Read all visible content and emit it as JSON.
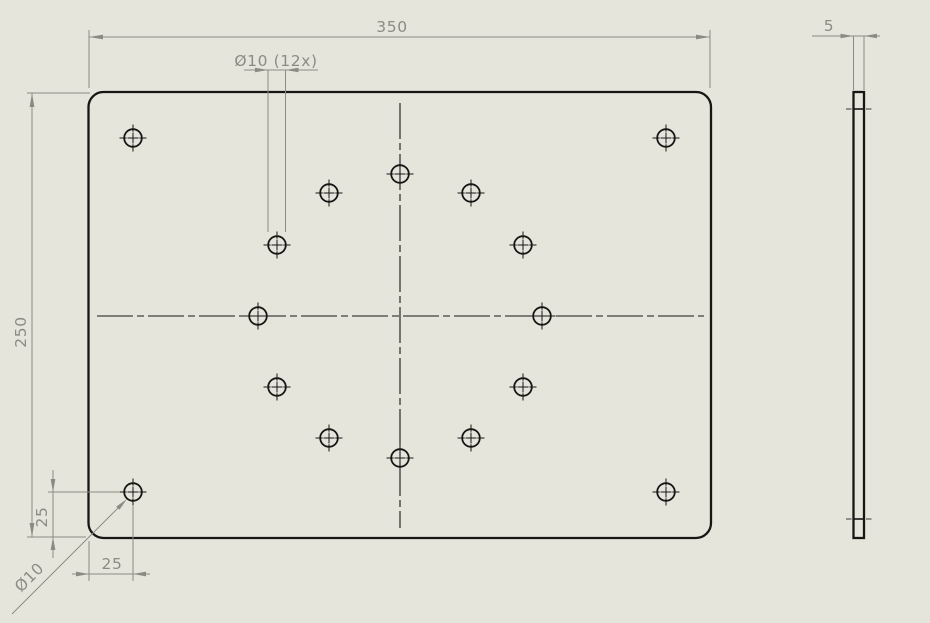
{
  "sheet": {
    "type": "cad-drawing",
    "background": "#e6e5dc",
    "geometry_color": "#161614",
    "dimension_color": "#8b8b85"
  },
  "views": {
    "front": {
      "plate_width_mm": 350,
      "plate_height_mm": 250,
      "hole_diameter_mm": 10,
      "pattern_hole_count": 12,
      "corner_offset_mm": 25,
      "hole_radius_px": 8.8,
      "centermark_inner_px": 5.5,
      "centermark_outer_px": 13.5,
      "corner_holes": [
        [
          133,
          138
        ],
        [
          666,
          138
        ],
        [
          133,
          492
        ],
        [
          666,
          492
        ]
      ],
      "pattern_holes": [
        [
          400,
          174
        ],
        [
          471,
          193
        ],
        [
          523,
          245
        ],
        [
          542,
          316
        ],
        [
          523,
          387
        ],
        [
          471,
          438
        ],
        [
          400,
          458
        ],
        [
          329,
          438
        ],
        [
          277,
          387
        ],
        [
          258,
          316
        ],
        [
          277,
          245
        ],
        [
          329,
          193
        ]
      ]
    },
    "side": {
      "thickness_mm": 5
    }
  },
  "dims": {
    "width": {
      "label": "350"
    },
    "height": {
      "label": "250"
    },
    "hole_pattern": {
      "label": "Ø10 (12x)"
    },
    "corner_hole_dia": {
      "label": "Ø10"
    },
    "corner_offset_x": {
      "label": "25"
    },
    "corner_offset_y": {
      "label": "25"
    },
    "thickness": {
      "label": "5"
    }
  }
}
